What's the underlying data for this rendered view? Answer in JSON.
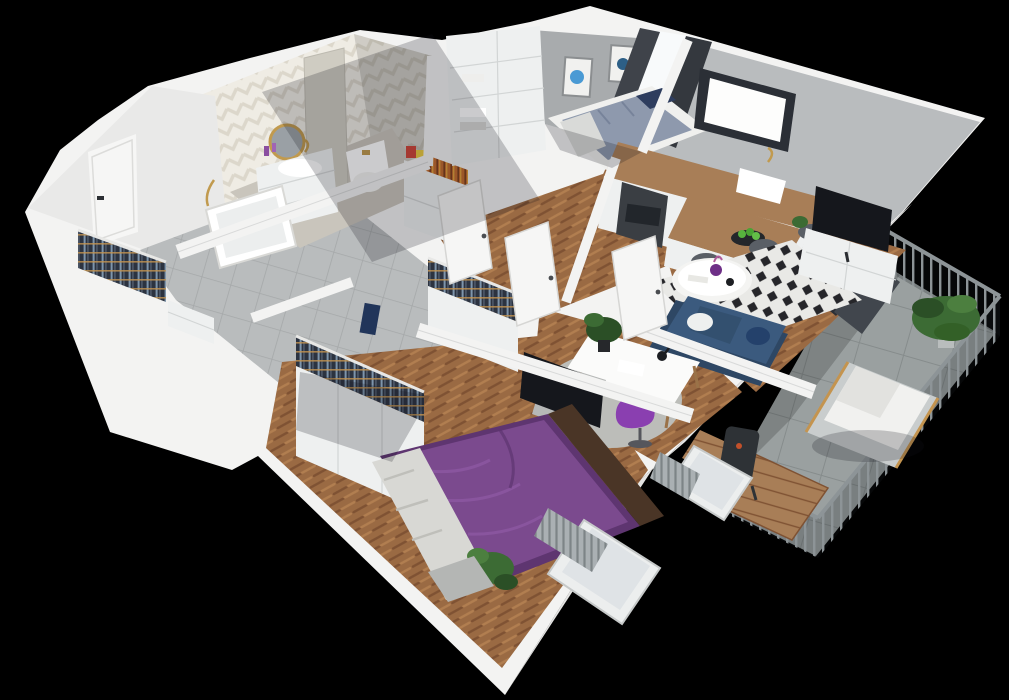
{
  "scene": {
    "description": "3D cutaway isometric render of a furnished one-bedroom apartment floor plan, viewed from above at an angle, on a black background",
    "style": "photoreal 3D floor plan, walls cut at waist height, no visible text",
    "background": "#000000"
  },
  "palette": {
    "bg": "#000000",
    "wall": "#f3f3f2",
    "wallShade": "#e4e4e3",
    "wallDark": "#c7c8c8",
    "wallFace": "#b9bcbe",
    "wallFaceDark": "#9fa2a4",
    "kidsWall": "#a8abad",
    "wood": "#9a6a43",
    "woodDark": "#7f5233",
    "woodLight": "#b17e50",
    "tile": "#b9bcbd",
    "tileLine": "#a5a8a9",
    "bathTileA": "#dcd7cb",
    "bathTileB": "#efece4",
    "concrete": "#9aa0a0",
    "concreteDark": "#868c8c",
    "counter": "#a87e57",
    "cabinet": "#eef0f0",
    "cabinetLine": "#d2d5d5",
    "bedPurple": "#7b4a8e",
    "bedPurpleDark": "#5e3570",
    "bedPurpleLight": "#8d58a3",
    "blanket": "#d8d8d4",
    "sofaBlue": "#3b5a7e",
    "sofaBlueDark": "#2e4764",
    "rugLight": "#e9e9e6",
    "rugDark": "#26262a",
    "officeRug": "#bcbdb9",
    "chairPurple": "#8a3fb0",
    "plantG": "#3c6b34",
    "plantD": "#2b4f26",
    "gold": "#c19a4e",
    "curtain": "#3f434a",
    "glassDark": "#2b2f36",
    "glassLight": "#f8fafb",
    "tv": "#15171c",
    "rail": "#8d9497",
    "railDark": "#5c6366",
    "clothesA": "#2c3340",
    "clothesB": "#7e95ab",
    "clothesC": "#4a5464",
    "hanger": "#c4944f",
    "stool": "#5a5f66",
    "doorWhite": "#f6f6f5",
    "bookA": "#c26b2e",
    "frameBlue": "#4a9ad4",
    "shadow": "rgba(18,20,26,0.22)"
  },
  "rooms": [
    {
      "name": "Entrance hall",
      "floor": "large gray tiles",
      "items": [
        "white front door with black handle",
        "open coat rack with hanging clothes",
        "shoe cabinet",
        "white dresser with books and boxes on top"
      ]
    },
    {
      "name": "Bathroom",
      "floor": "light tile",
      "items": [
        "chevron herringbone tiled walls",
        "round mirror with gold frame",
        "white floating vanity with basin and gold faucet",
        "bathtub with gold shower fixture",
        "toilet",
        "tiled column",
        "navy towel"
      ]
    },
    {
      "name": "Small bedroom",
      "floor": "herringbone wood",
      "items": [
        "single bed with blue patterned bedding and navy pillows",
        "tall white wardrobe with folded linens",
        "two framed blue artworks",
        "dark gray curtains at balcony window"
      ]
    },
    {
      "name": "Kitchen",
      "floor": "herringbone wood",
      "items": [
        "L-shaped white cabinets with wood countertop",
        "window with dark frame",
        "oven",
        "white sink with gold faucet",
        "breakfast bar peninsula",
        "three dark bar stools",
        "bowl of green fruit"
      ]
    },
    {
      "name": "Living room",
      "floor": "herringbone wood",
      "items": [
        "navy blue sofa with white pillow",
        "round white coffee table with purple vase",
        "black and white diamond pattern rug",
        "white TV console with flat TV",
        "small plant",
        "dark framed balcony doors"
      ]
    },
    {
      "name": "Home office",
      "floor": "herringbone wood",
      "items": [
        "white desk with wooden legs",
        "purple designer chair",
        "gray armchair with dotted pillow",
        "gray shaggy rug",
        "black desk lamp",
        "wine bottle",
        "potted plant",
        "window with radiator"
      ]
    },
    {
      "name": "Master bedroom",
      "floor": "herringbone wood",
      "items": [
        "double bed with purple duvet and light blanket",
        "two white wardrobes with open tops showing hanging clothes",
        "wall mounted TV",
        "gray bench",
        "potted plant",
        "window with radiator below"
      ]
    },
    {
      "name": "Corridor",
      "floor": "herringbone wood and gray tile",
      "items": [
        "white interior doors standing open",
        "navy towel niche"
      ]
    },
    {
      "name": "Balcony",
      "floor": "large concrete tiles",
      "items": [
        "gray metal railing with vertical bars",
        "white cushioned lounge chair with wood frame",
        "low wooden table",
        "wood slat bench",
        "dark grill",
        "two potted green plants"
      ]
    }
  ]
}
